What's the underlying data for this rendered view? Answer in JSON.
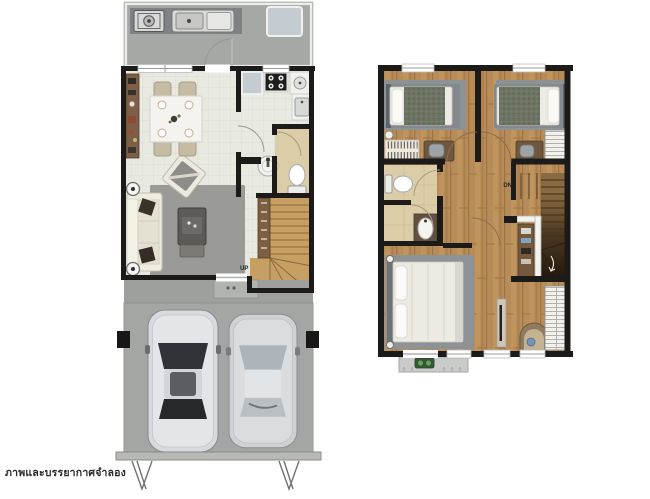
{
  "caption": "ภาพและบรรยากาศจำลอง",
  "floor1": {
    "stair_label": "UP",
    "icons": [
      "washing-machine-icon",
      "laundry-sink-icon",
      "water-tank-icon",
      "door-swing-icon",
      "refrigerator-icon",
      "stove-icon",
      "kitchen-sink-icon",
      "washbasin-icon",
      "toilet-icon",
      "dining-table-icon",
      "dining-chair-icon",
      "console-shelf-icon",
      "sofa-icon",
      "armchair-icon",
      "coffee-table-icon",
      "rug-icon",
      "floor-lamp-icon",
      "staircase-up-icon",
      "car-icon",
      "carport-post-icon",
      "gate-mark-icon"
    ]
  },
  "floor2": {
    "stair_label": "DN",
    "icons": [
      "single-bed-icon",
      "wall-lamp-icon",
      "bookshelf-icon",
      "desk-icon",
      "desk-chair-icon",
      "wardrobe-icon",
      "toilet-icon",
      "washbasin-icon",
      "double-bed-icon",
      "nightstand-lamp-icon",
      "tv-console-icon",
      "dressing-table-icon",
      "stool-icon",
      "staircase-down-icon",
      "balcony-icon",
      "ac-unit-icon"
    ]
  },
  "colors": {
    "background": "#ffffff",
    "wall": "#1c1b19",
    "tile_floor": "#e8eae2",
    "wood_floor": "#b88c58",
    "bathroom_floor": "#dbcda7",
    "concrete_carport": "#a4a6a3",
    "utility_gray": "#a6a8a5",
    "rug_gray": "#9a9a96",
    "bed_mat_gray": "#8d9295",
    "ac_green": "#335c33",
    "caption_text": "#2b2b2b"
  }
}
